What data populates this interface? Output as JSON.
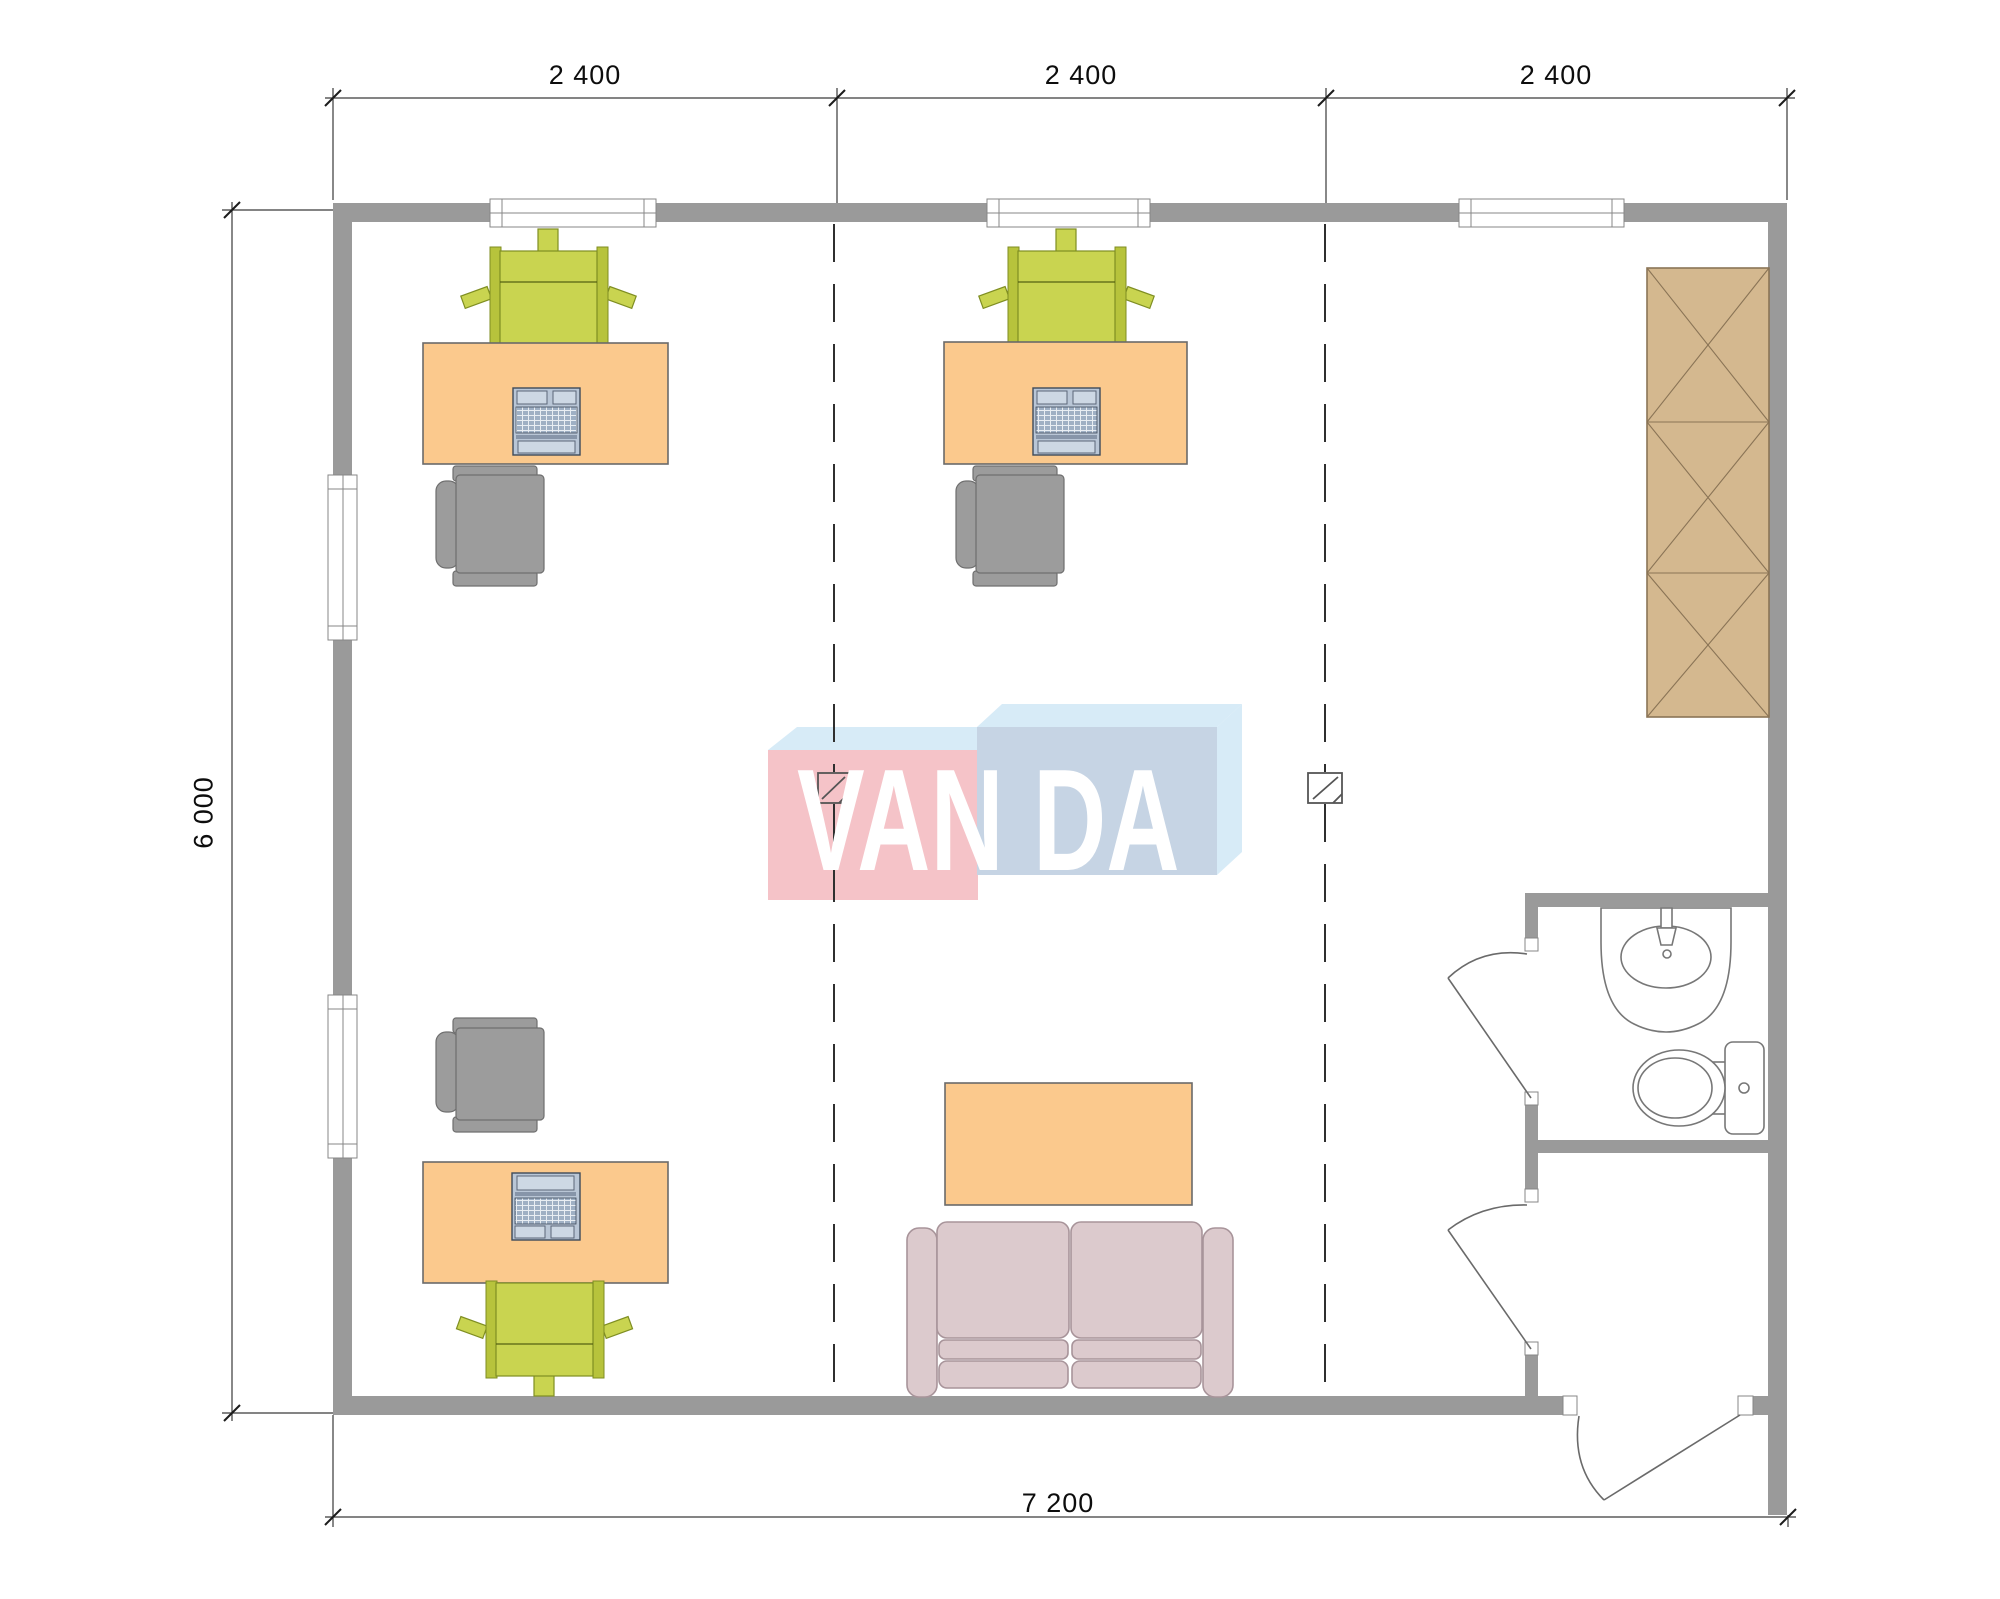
{
  "dimensions": {
    "top": [
      "2 400",
      "2 400",
      "2 400"
    ],
    "left": "6 000",
    "bottom": "7 200"
  },
  "watermark": {
    "left": "VAN",
    "right": "DA"
  },
  "colors": {
    "wall": "#9a9a9a",
    "desk": "#fbc98d",
    "chair-green": "#c9d450",
    "chair-gray": "#9c9c9c",
    "sofa": "#dccacd",
    "wardrobe": "#d4b88f",
    "logo-pink": "#f5c3c8",
    "logo-blue": "#c6d4e4",
    "logo-lightblue": "#d7ebf7"
  }
}
